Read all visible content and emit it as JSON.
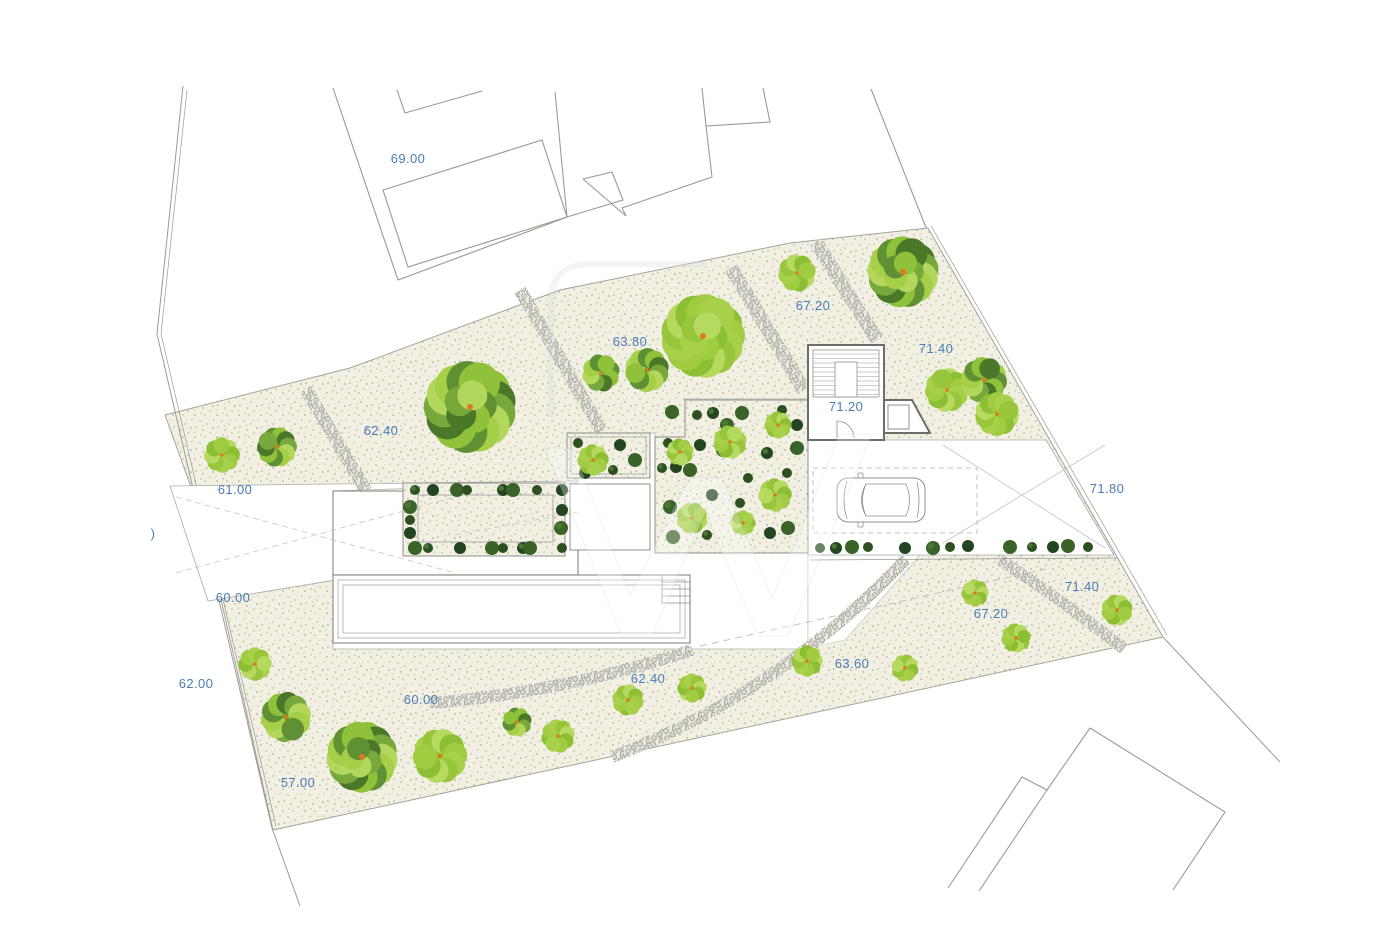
{
  "drawing": {
    "kind": "architectural-site-plan",
    "watermark_present": true,
    "car_present": true
  },
  "colors": {
    "label": "#4a7cb8",
    "ground_base": "#f1f0e3",
    "line": "#9a9a94",
    "wall": "#6e6e68",
    "path_bg": "#eceae0",
    "trunk": "#dd7a1e",
    "tree_light": [
      "#a8d14b",
      "#97c63b",
      "#b6da60",
      "#8dbf35",
      "#a0cc42"
    ],
    "tree_mixed": [
      "#a4cf47",
      "#5f9134",
      "#8fc23a",
      "#4a7828",
      "#76a83c",
      "#b2d75c"
    ],
    "bush_shades": [
      "#2c511f",
      "#234420",
      "#3a6328"
    ]
  },
  "labels": [
    {
      "text": "69.00",
      "x": 408,
      "y": 163
    },
    {
      "text": "63.80",
      "x": 630,
      "y": 346
    },
    {
      "text": "67.20",
      "x": 813,
      "y": 310
    },
    {
      "text": "71.40",
      "x": 936,
      "y": 353
    },
    {
      "text": "62.40",
      "x": 381,
      "y": 435
    },
    {
      "text": "71.20",
      "x": 846,
      "y": 411
    },
    {
      "text": "61.00",
      "x": 235,
      "y": 494
    },
    {
      "text": ")",
      "x": 153,
      "y": 538
    },
    {
      "text": "71.80",
      "x": 1107,
      "y": 493
    },
    {
      "text": "60.00",
      "x": 233,
      "y": 602
    },
    {
      "text": "71.40",
      "x": 1082,
      "y": 591
    },
    {
      "text": "67.20",
      "x": 991,
      "y": 618
    },
    {
      "text": "62.00",
      "x": 196,
      "y": 688
    },
    {
      "text": "60.00",
      "x": 421,
      "y": 704
    },
    {
      "text": "62.40",
      "x": 648,
      "y": 683
    },
    {
      "text": "63.60",
      "x": 852,
      "y": 668
    },
    {
      "text": "57.00",
      "x": 298,
      "y": 787
    }
  ],
  "trees": [
    [
      222,
      455,
      17,
      "L"
    ],
    [
      277,
      447,
      19,
      "M"
    ],
    [
      470,
      407,
      44,
      "M"
    ],
    [
      601,
      373,
      18,
      "M"
    ],
    [
      647,
      370,
      21,
      "M"
    ],
    [
      703,
      336,
      40,
      "L"
    ],
    [
      797,
      273,
      18,
      "L"
    ],
    [
      903,
      272,
      34,
      "M"
    ],
    [
      947,
      390,
      21,
      "L"
    ],
    [
      984,
      380,
      22,
      "M"
    ],
    [
      997,
      414,
      21,
      "L"
    ],
    [
      255,
      664,
      16,
      "L"
    ],
    [
      286,
      717,
      24,
      "M"
    ],
    [
      362,
      757,
      34,
      "M"
    ],
    [
      440,
      756,
      26,
      "L"
    ],
    [
      517,
      722,
      14,
      "M"
    ],
    [
      558,
      736,
      16,
      "L"
    ],
    [
      628,
      700,
      15,
      "L"
    ],
    [
      692,
      688,
      14,
      "L"
    ],
    [
      807,
      661,
      15,
      "L"
    ],
    [
      905,
      668,
      13,
      "L"
    ],
    [
      975,
      593,
      13,
      "L"
    ],
    [
      1016,
      638,
      14,
      "L"
    ],
    [
      1117,
      610,
      15,
      "L"
    ],
    [
      730,
      442,
      16,
      "L"
    ],
    [
      778,
      425,
      13,
      "L"
    ],
    [
      775,
      495,
      16,
      "L"
    ],
    [
      692,
      518,
      15,
      "L"
    ],
    [
      743,
      523,
      12,
      "L"
    ],
    [
      680,
      452,
      13,
      "L"
    ],
    [
      593,
      460,
      15,
      "L"
    ]
  ],
  "bushes": [
    [
      415,
      490
    ],
    [
      433,
      490
    ],
    [
      457,
      490
    ],
    [
      467,
      490
    ],
    [
      503,
      490
    ],
    [
      513,
      490
    ],
    [
      537,
      490
    ],
    [
      562,
      490
    ],
    [
      410,
      507
    ],
    [
      410,
      520
    ],
    [
      410,
      533
    ],
    [
      415,
      548
    ],
    [
      428,
      548
    ],
    [
      460,
      548
    ],
    [
      492,
      548
    ],
    [
      503,
      548
    ],
    [
      523,
      548
    ],
    [
      530,
      548
    ],
    [
      562,
      548
    ],
    [
      562,
      510
    ],
    [
      561,
      528
    ],
    [
      578,
      443
    ],
    [
      620,
      445
    ],
    [
      635,
      460
    ],
    [
      613,
      470
    ],
    [
      585,
      473
    ],
    [
      672,
      412
    ],
    [
      697,
      415
    ],
    [
      713,
      413
    ],
    [
      742,
      413
    ],
    [
      782,
      410
    ],
    [
      797,
      425
    ],
    [
      727,
      425
    ],
    [
      668,
      443
    ],
    [
      700,
      445
    ],
    [
      723,
      450
    ],
    [
      662,
      468
    ],
    [
      676,
      467
    ],
    [
      690,
      470
    ],
    [
      748,
      478
    ],
    [
      767,
      453
    ],
    [
      797,
      448
    ],
    [
      787,
      473
    ],
    [
      712,
      495
    ],
    [
      670,
      507
    ],
    [
      740,
      503
    ],
    [
      770,
      500
    ],
    [
      673,
      537
    ],
    [
      707,
      535
    ],
    [
      770,
      533
    ],
    [
      788,
      528
    ],
    [
      820,
      548
    ],
    [
      836,
      548
    ],
    [
      852,
      547
    ],
    [
      868,
      547
    ],
    [
      905,
      548
    ],
    [
      933,
      548
    ],
    [
      950,
      547
    ],
    [
      968,
      546
    ],
    [
      1010,
      547
    ],
    [
      1032,
      547
    ],
    [
      1053,
      547
    ],
    [
      1068,
      546
    ],
    [
      1088,
      547
    ]
  ]
}
